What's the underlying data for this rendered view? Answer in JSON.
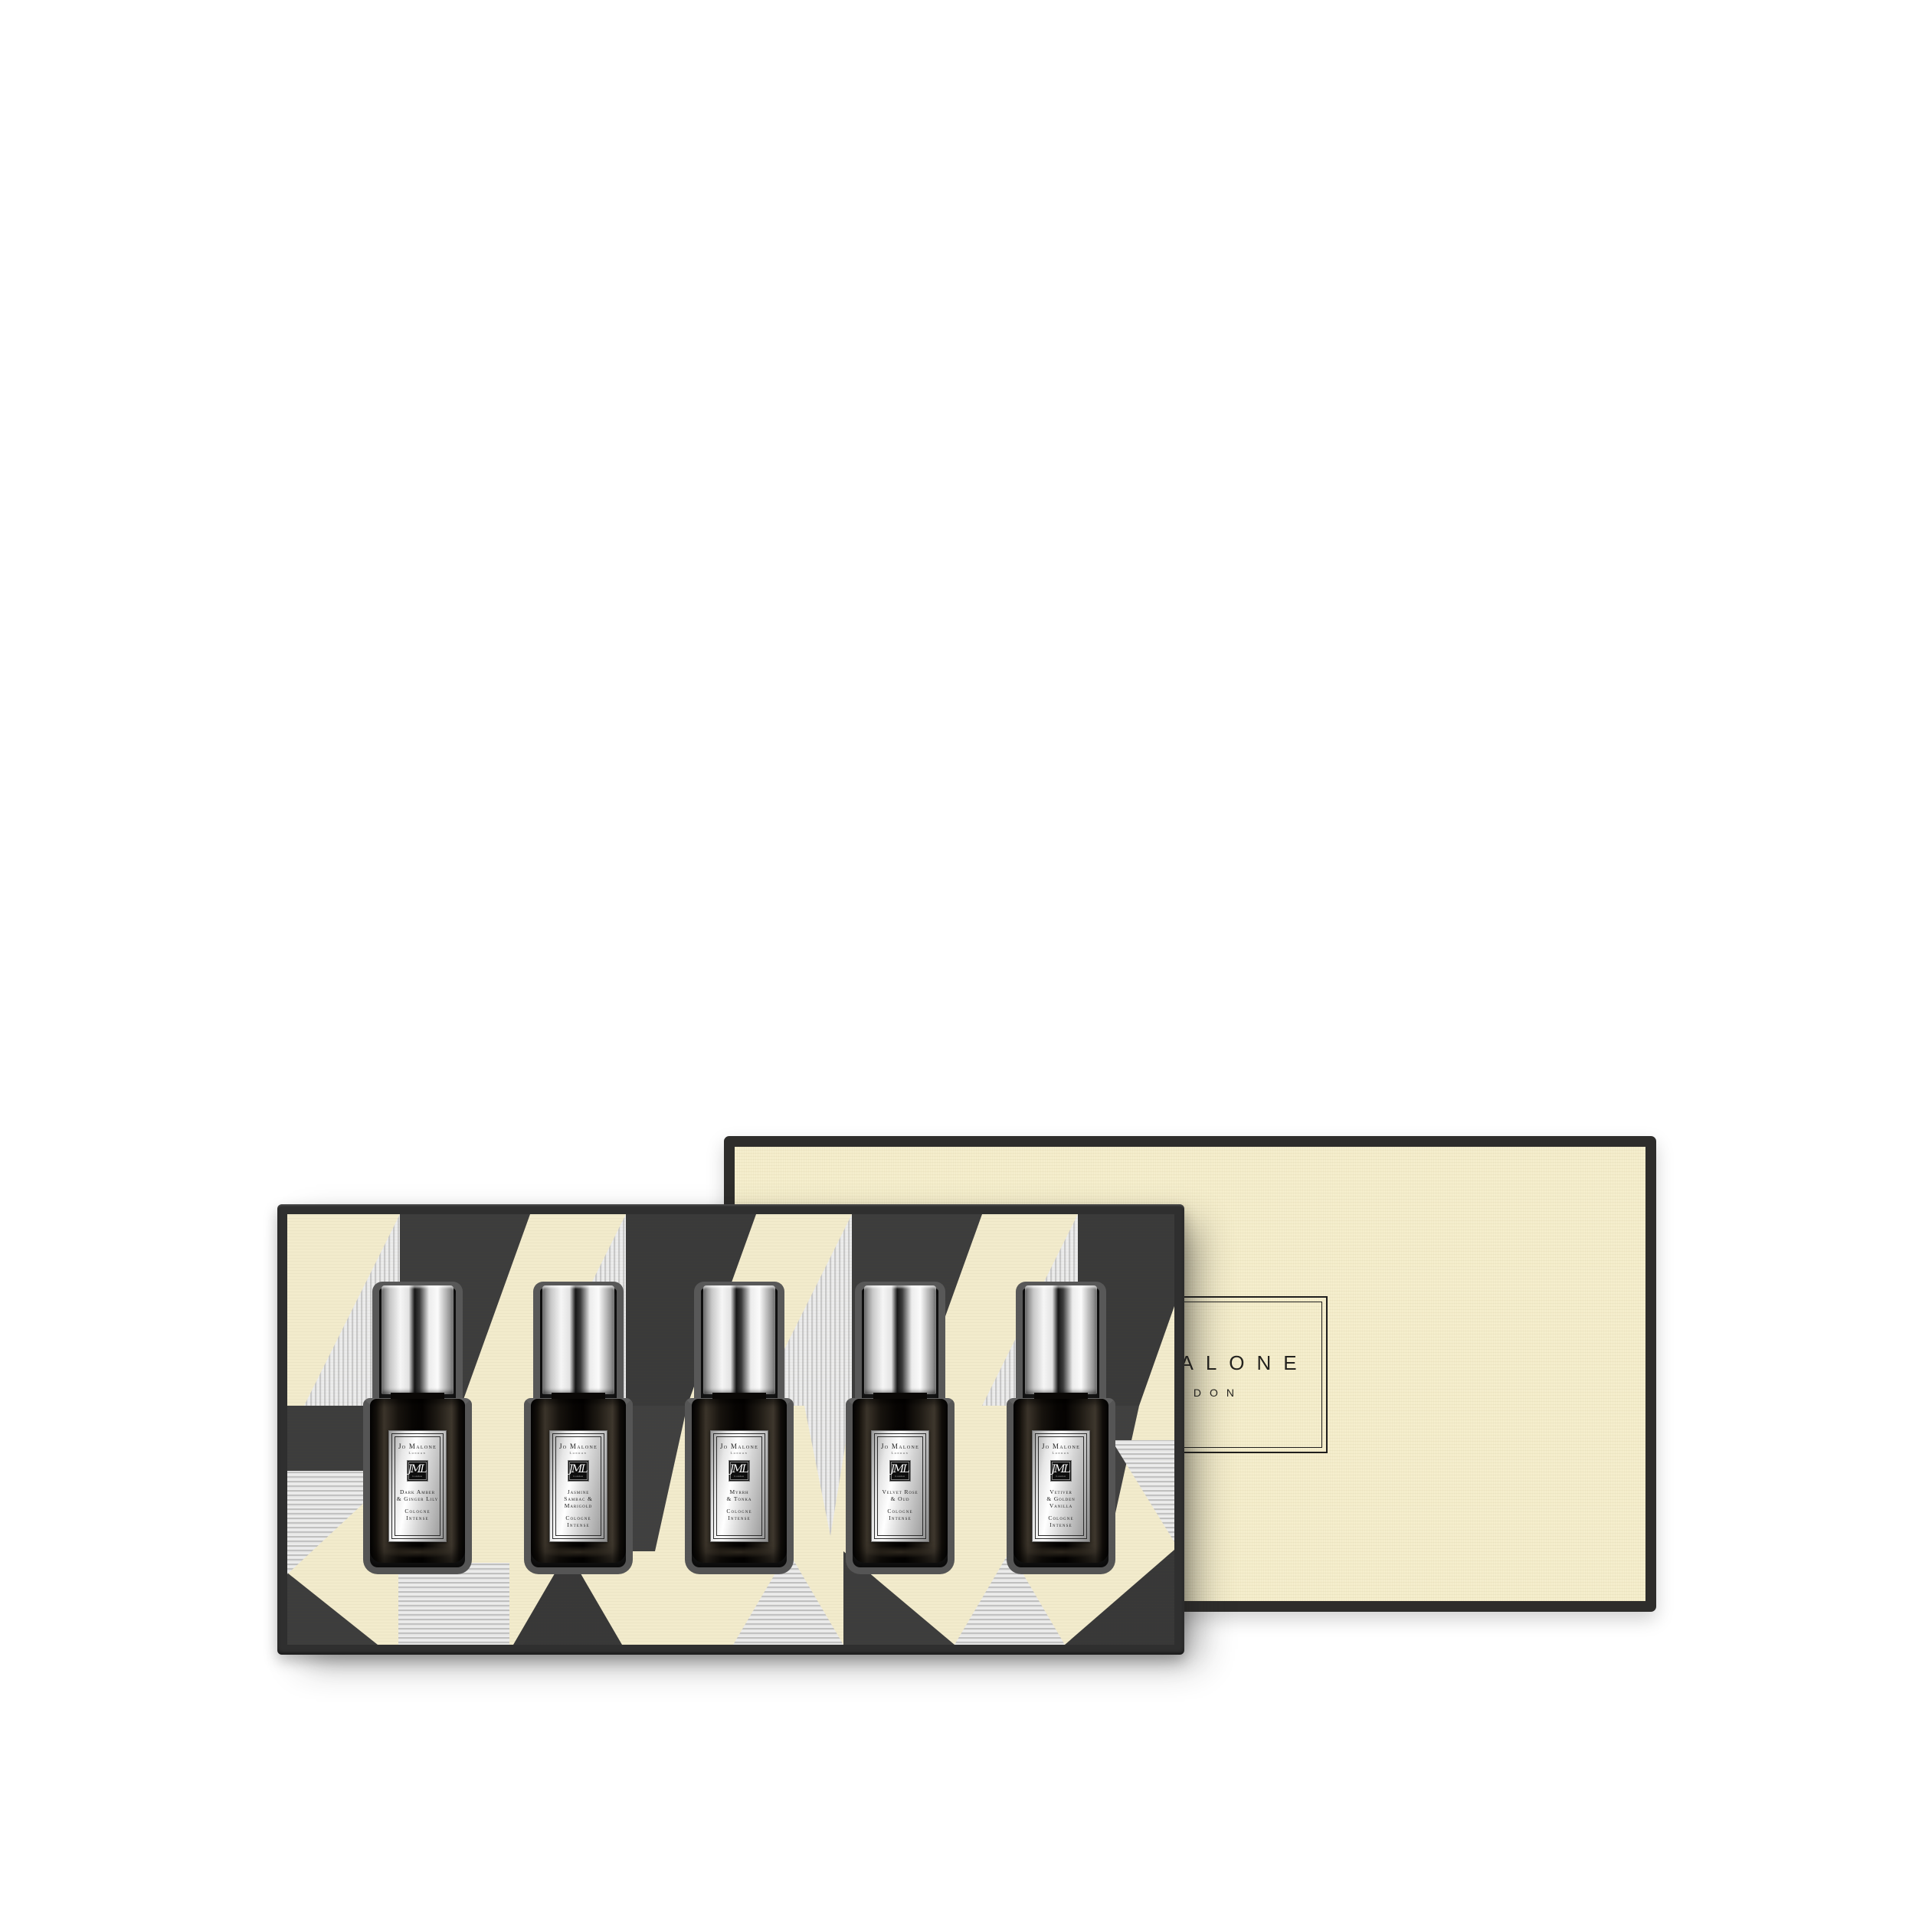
{
  "lid": {
    "brand": "Jo Malone",
    "city": "London"
  },
  "bottles": [
    {
      "brand": "Jo Malone",
      "city": "London",
      "monogram": "JML",
      "name": "Dark Amber\n& Ginger Lily",
      "type": "Cologne\nIntense"
    },
    {
      "brand": "Jo Malone",
      "city": "London",
      "monogram": "JML",
      "name": "Jasmine\nSambac &\nMarigold",
      "type": "Cologne\nIntense"
    },
    {
      "brand": "Jo Malone",
      "city": "London",
      "monogram": "JML",
      "name": "Myrrh\n& Tonka",
      "type": "Cologne\nIntense"
    },
    {
      "brand": "Jo Malone",
      "city": "London",
      "monogram": "JML",
      "name": "Velvet Rose\n& Oud",
      "type": "Cologne\nIntense"
    },
    {
      "brand": "Jo Malone",
      "city": "London",
      "monogram": "JML",
      "name": "Vetiver\n& Golden\nVanilla",
      "type": "Cologne\nIntense"
    }
  ],
  "colors": {
    "page_background": "#ffffff",
    "lid_cream": "#f5eecd",
    "board_cream": "#f2ebcc",
    "pattern_charcoal": "#3d3d3d",
    "pattern_silver": "#ebebeb",
    "tray_frame": "#2f2f2f",
    "bottle_glass": "#16120d",
    "cap_silver": "#e2e2e2",
    "label_silver": "#d4d4d4"
  }
}
